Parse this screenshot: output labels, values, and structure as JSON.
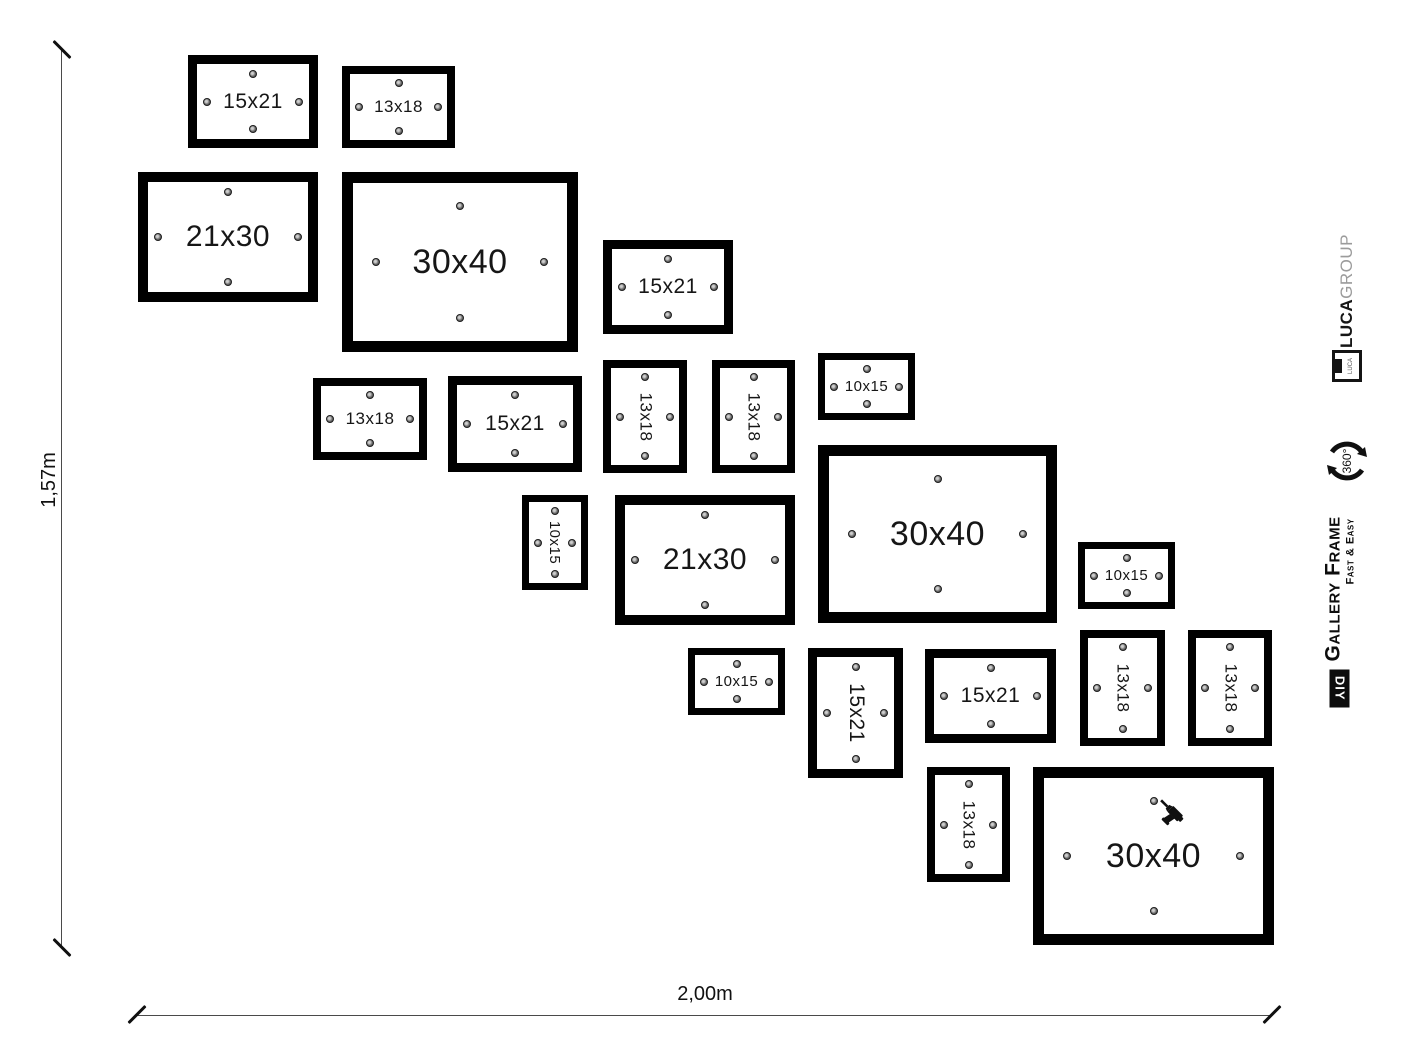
{
  "dimensions": {
    "height_label": "1,57m",
    "width_label": "2,00m"
  },
  "branding": {
    "luca_bold": "LUCA",
    "luca_light": "GROUP",
    "luca_logo_text": "LUCA",
    "rotation_label": "360°",
    "gallery_title": "Gallery Frame",
    "gallery_tagline": "Fast & Easy",
    "diy_label": "DIY"
  },
  "colors": {
    "frame_border": "#000000",
    "screw_dot": "#6e6e6e",
    "luca_group_gray": "#9b9b9b",
    "dimension_line": "#4a4a4a"
  },
  "frames": [
    {
      "label": "15x21",
      "size": "15x21",
      "orientation": "landscape",
      "x": 188,
      "y": 55,
      "w": 130,
      "h": 93
    },
    {
      "label": "13x18",
      "size": "13x18",
      "orientation": "landscape",
      "x": 342,
      "y": 66,
      "w": 113,
      "h": 82
    },
    {
      "label": "21x30",
      "size": "21x30",
      "orientation": "landscape",
      "x": 138,
      "y": 172,
      "w": 180,
      "h": 130
    },
    {
      "label": "30x40",
      "size": "30x40",
      "orientation": "landscape",
      "x": 342,
      "y": 172,
      "w": 236,
      "h": 180
    },
    {
      "label": "15x21",
      "size": "15x21",
      "orientation": "landscape",
      "x": 603,
      "y": 240,
      "w": 130,
      "h": 94
    },
    {
      "label": "13x18",
      "size": "13x18",
      "orientation": "portrait",
      "x": 603,
      "y": 360,
      "w": 84,
      "h": 113
    },
    {
      "label": "13x18",
      "size": "13x18",
      "orientation": "portrait",
      "x": 712,
      "y": 360,
      "w": 83,
      "h": 113
    },
    {
      "label": "10x15",
      "size": "10x15",
      "orientation": "landscape",
      "x": 818,
      "y": 353,
      "w": 97,
      "h": 67
    },
    {
      "label": "13x18",
      "size": "13x18",
      "orientation": "landscape",
      "x": 313,
      "y": 378,
      "w": 114,
      "h": 82
    },
    {
      "label": "15x21",
      "size": "15x21",
      "orientation": "landscape",
      "x": 448,
      "y": 376,
      "w": 134,
      "h": 96
    },
    {
      "label": "30x40",
      "size": "30x40",
      "orientation": "landscape",
      "x": 818,
      "y": 445,
      "w": 239,
      "h": 178
    },
    {
      "label": "10x15",
      "size": "10x15",
      "orientation": "portrait",
      "x": 522,
      "y": 495,
      "w": 66,
      "h": 95
    },
    {
      "label": "21x30",
      "size": "21x30",
      "orientation": "landscape",
      "x": 615,
      "y": 495,
      "w": 180,
      "h": 130
    },
    {
      "label": "10x15",
      "size": "10x15",
      "orientation": "landscape",
      "x": 1078,
      "y": 542,
      "w": 97,
      "h": 67
    },
    {
      "label": "10x15",
      "size": "10x15",
      "orientation": "landscape",
      "x": 688,
      "y": 648,
      "w": 97,
      "h": 67
    },
    {
      "label": "15x21",
      "size": "15x21",
      "orientation": "portrait",
      "x": 808,
      "y": 648,
      "w": 95,
      "h": 130
    },
    {
      "label": "15x21",
      "size": "15x21",
      "orientation": "landscape",
      "x": 925,
      "y": 649,
      "w": 131,
      "h": 94
    },
    {
      "label": "13x18",
      "size": "13x18",
      "orientation": "portrait",
      "x": 1080,
      "y": 630,
      "w": 85,
      "h": 116
    },
    {
      "label": "13x18",
      "size": "13x18",
      "orientation": "portrait",
      "x": 1188,
      "y": 630,
      "w": 84,
      "h": 116
    },
    {
      "label": "13x18",
      "size": "13x18",
      "orientation": "portrait",
      "x": 927,
      "y": 767,
      "w": 83,
      "h": 115
    },
    {
      "label": "30x40",
      "size": "30x40",
      "orientation": "landscape",
      "x": 1033,
      "y": 767,
      "w": 241,
      "h": 178,
      "drill": true
    }
  ]
}
